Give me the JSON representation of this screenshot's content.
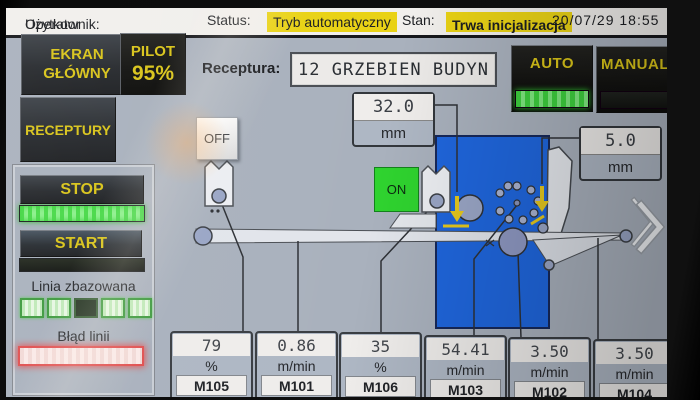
{
  "top_bar": {
    "user_label": "Użytkownik:",
    "user_value": "Operator",
    "status_label": "Status:",
    "status_value": "Tryb automatyczny",
    "state_label": "Stan:",
    "state_value": "Trwa inicjalizacja",
    "datetime": "20/07/29 18:55"
  },
  "sidebar": {
    "main_screen_button": "EKRAN GŁÓWNY",
    "pilot_label": "PILOT",
    "pilot_value": "95%",
    "recipes_button": "RECEPTURY",
    "stop_button": "STOP",
    "stop_indicator": "on",
    "start_button": "START",
    "start_indicator": "off",
    "line_homed_label": "Linia zbazowana",
    "line_homed_indicators": [
      "on",
      "on",
      "off",
      "on",
      "on"
    ],
    "line_error_label": "Błąd linii",
    "line_error_state": "error"
  },
  "recipe": {
    "label": "Receptura:",
    "value": "12 GRZEBIEN BUDYN"
  },
  "mode": {
    "auto_label": "AUTO",
    "auto_indicator": "on",
    "manual_label": "MANUAL",
    "manual_indicator": "off"
  },
  "machine": {
    "off_button": "OFF",
    "on_button": "ON",
    "setpoint_comb": {
      "value": "32.0",
      "unit": "mm"
    },
    "setpoint_knife": {
      "value": "5.0",
      "unit": "mm"
    }
  },
  "meters": [
    {
      "value": "79",
      "unit": "%",
      "motor": "M105"
    },
    {
      "value": "0.86",
      "unit": "m/min",
      "motor": "M101"
    },
    {
      "value": "35",
      "unit": "%",
      "motor": "M106"
    },
    {
      "value": "54.41",
      "unit": "m/min",
      "motor": "M103"
    },
    {
      "value": "3.50",
      "unit": "m/min",
      "motor": "M102"
    },
    {
      "value": "3.50",
      "unit": "m/min",
      "motor": "M104"
    }
  ],
  "icons": {
    "next_page": "chevron-right"
  },
  "colors": {
    "accent_yellow": "#d9c419",
    "highlight_yellow": "#e9d215",
    "indicator_green": "#2fd32f",
    "machine_blue": "#1f66dd",
    "error_red": "#e05050",
    "panel_gray": "#a9b1bd"
  }
}
